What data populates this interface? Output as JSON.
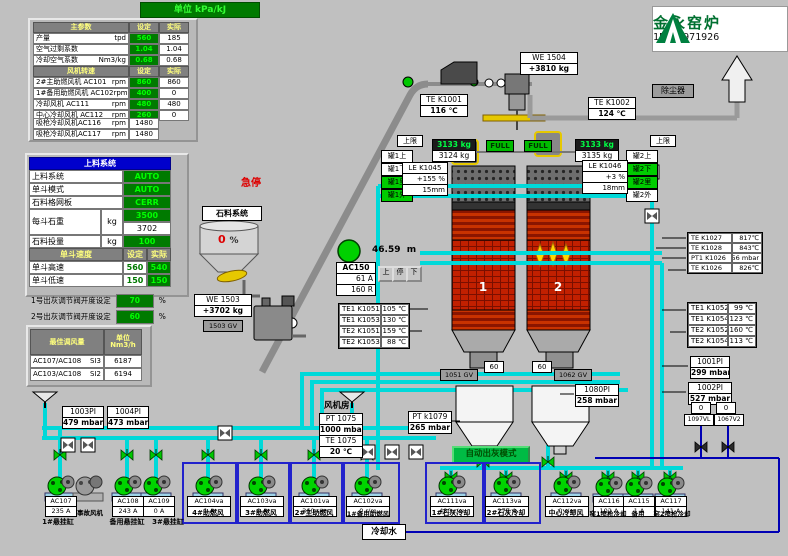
{
  "titlebar": {
    "unit_label": "单位 kPa/kJ"
  },
  "logo": {
    "title": "金永窑炉",
    "phone": "15020971926"
  },
  "params_table": {
    "title": "主参数",
    "col_set": "设定",
    "col_act": "实际",
    "rows": [
      {
        "name": "产量",
        "unit": "tpd",
        "set": "560",
        "act": "185"
      },
      {
        "name": "空气过剩系数",
        "unit": "",
        "set": "1.04",
        "act": "1.04"
      },
      {
        "name": "冷却空气系数",
        "unit": "Nm3/kg",
        "set": "0.68",
        "act": "0.68"
      }
    ],
    "fan_title": "风机转速",
    "fan_col_set": "设定",
    "fan_col_act": "实际",
    "fan_rows": [
      {
        "name": "2#主助燃风机 AC101",
        "unit": "rpm",
        "set": "860",
        "act": "860"
      },
      {
        "name": "1#备用助燃风机 AC102",
        "unit": "rpm",
        "set": "400",
        "act": "0"
      },
      {
        "name": "冷却风机 AC111",
        "unit": "rpm",
        "set": "480",
        "act": "480"
      },
      {
        "name": "中心冷却风机 AC112",
        "unit": "rpm",
        "set": "260",
        "act": "0"
      }
    ],
    "extra_rows": [
      {
        "name": "吸枪冷却风机AC116",
        "unit": "rpm",
        "val": "1480"
      },
      {
        "name": "吸枪冷却风机AC117",
        "unit": "rpm",
        "val": "1480"
      }
    ]
  },
  "feed_panel": {
    "title": "上料系统",
    "rows": [
      {
        "name": "上料系统",
        "value": "AUTO"
      },
      {
        "name": "单斗模式",
        "value": "AUTO"
      },
      {
        "name": "石料格网板",
        "value": "CERR"
      }
    ],
    "weight_row": {
      "name": "每斗石重",
      "unit": "kg",
      "set": "3500",
      "act": "3702"
    },
    "dose_row": {
      "name": "石料投量",
      "unit": "kg",
      "value": "100"
    },
    "speed_title": "单斗速度",
    "speed_col_set": "设定",
    "speed_col_act": "实际",
    "speed_rows": [
      {
        "name": "单斗高速",
        "set": "560",
        "act": "540"
      },
      {
        "name": "单斗低速",
        "set": "150",
        "act": "150"
      }
    ]
  },
  "ash_valves": [
    {
      "label": "1号出灰调节阀开度设定",
      "value": "70",
      "unit": "%"
    },
    {
      "label": "2号出灰调节阀开度设定",
      "value": "60",
      "unit": "%"
    }
  ],
  "airflow_table": {
    "title": "最佳调风量",
    "unit_header": "单位 Nm3/h",
    "rows": [
      {
        "name": "AC107/AC108",
        "tag": "SI3",
        "value": "6187"
      },
      {
        "name": "AC103/AC108",
        "tag": "SI2",
        "value": "6194"
      }
    ]
  },
  "estop_label": "急停",
  "stone_system": {
    "label": "石料系统",
    "hopper_value": "0",
    "hopper_unit": "%",
    "weigher_tag": "WE 1503",
    "weigher_value": "+3702 kg",
    "gate_tag": "1503 GV"
  },
  "conveyor": {
    "height_value": "46.59",
    "height_unit": "m",
    "drive_tag": "AC150",
    "drive_current": "61 A",
    "drive_speed": "160 R",
    "btn_up": "上",
    "btn_stop": "停",
    "btn_down": "下"
  },
  "skip": {
    "weigher_tag": "WE 1504",
    "weigher_value": "+3810 kg",
    "left_weight_set": "3133 kg",
    "left_weight_act": "3124 kg",
    "right_weight_set": "3133 kg",
    "right_weight_act": "3135 kg",
    "full_left": "FULL",
    "full_right": "FULL",
    "limit_left": "上限",
    "limit_right": "上限"
  },
  "dust_collector_label": "除尘器",
  "kilns": {
    "kiln1_no": "1",
    "kiln2_no": "2",
    "tank1_labels": [
      "罐1上",
      "罐1下",
      "罐1里",
      "罐1外"
    ],
    "tank2_labels": [
      "罐2上",
      "罐2下",
      "罐2里",
      "罐2外"
    ],
    "le1": {
      "tag": "LE K1045",
      "v1": "+155 %",
      "v2": "15mm"
    },
    "le2": {
      "tag": "LE K1046",
      "v1": "+3 %",
      "v2": "18mm"
    },
    "te1": {
      "tag": "TE K1001",
      "value": "116 ℃"
    },
    "te2": {
      "tag": "TE K1002",
      "value": "124 ℃"
    }
  },
  "left_te_group": [
    {
      "tag": "TE1 K1051",
      "value": "105 ℃"
    },
    {
      "tag": "TE1 K1053",
      "value": "130 ℃"
    },
    {
      "tag": "TE2 K1051",
      "value": "159 ℃"
    },
    {
      "tag": "TE2 K1053",
      "value": "88 ℃"
    }
  ],
  "right_te_group1": [
    {
      "tag": "TE K1027",
      "value": "817℃"
    },
    {
      "tag": "TE K1028",
      "value": "843℃"
    },
    {
      "tag": "PT1 K1026",
      "value": "256 mbar"
    },
    {
      "tag": "TE K1026",
      "value": "826℃"
    }
  ],
  "right_te_group2": [
    {
      "tag": "TE1 K1052",
      "value": "99 ℃"
    },
    {
      "tag": "TE1 K1054",
      "value": "123 ℃"
    },
    {
      "tag": "TE2 K1052",
      "value": "160 ℃"
    },
    {
      "tag": "TE2 K1054",
      "value": "113 ℃"
    }
  ],
  "right_pi": [
    {
      "tag": "1001PI",
      "value": "299 mbar"
    },
    {
      "tag": "1002PI",
      "value": "527 mbar"
    }
  ],
  "discharge": {
    "left_pos": "60",
    "right_pos": "60",
    "left_gv": "1051 GV",
    "right_gv": "1062 GV",
    "pi_tag": "1080PI",
    "pi_value": "258 mbar",
    "auto_mode_label": "自动出灰模式"
  },
  "fanroom": {
    "label": "风机房",
    "pt_tag": "PT 1075",
    "pt_value": "1000 mbar",
    "te_tag": "TE 1075",
    "te_value": "20 ℃",
    "pt2_tag": "PT k1079",
    "pt2_value": "265 mbar",
    "pi3_tag": "1003PI",
    "pi3_value": "479 mbar",
    "pi4_tag": "1004PI",
    "pi4_value": "473 mbar"
  },
  "cooling": {
    "label": "冷却水",
    "v1_pos": "0",
    "v2_pos": "0",
    "v1_tag": "1097VL",
    "v2_tag": "1067V2"
  },
  "pumps": [
    {
      "id": "AC107",
      "value": "235 A",
      "label": "1#悬挂缸"
    },
    {
      "id": "",
      "value": "",
      "label": "事故风机"
    },
    {
      "id": "AC108",
      "value": "243 A",
      "label": "备用悬挂缸"
    },
    {
      "id": "AC109",
      "value": "0 A",
      "label": "3#悬挂缸"
    },
    {
      "id": "AC104va",
      "value": "1 A",
      "label": "4#助燃风"
    },
    {
      "id": "AC103va",
      "value": "0 A",
      "label": "3#助燃风"
    },
    {
      "id": "AC101va",
      "value": "360 r/m",
      "label": "2#主助燃风"
    },
    {
      "id": "AC102va",
      "value": "0 r/m",
      "label": "1#备用助燃风"
    },
    {
      "id": "AC111va",
      "value": "480 r/m",
      "label": "1#石灰冷却"
    },
    {
      "id": "AC113va",
      "value": "277 A",
      "label": "2#石灰冷却"
    },
    {
      "id": "AC112va",
      "value": "0 r/m",
      "label": "中心冷却风"
    },
    {
      "id": "AC116",
      "value": "102 A",
      "label": "窑1喷枪冷却"
    },
    {
      "id": "AC115",
      "value": "1 A",
      "label": "备用"
    },
    {
      "id": "AC117",
      "value": "141 A",
      "label": "窑2喷枪冷却"
    }
  ],
  "colors": {
    "background": "#c0c0c0",
    "setpoint_green": "#007a00",
    "bright_green": "#00ff00",
    "pipe_cyan": "#00d9d9",
    "cooling_blue": "#0000b4",
    "kiln_red": "#c22000",
    "panel_blue": "#0000cc",
    "alarm_red": "#dd0000"
  }
}
